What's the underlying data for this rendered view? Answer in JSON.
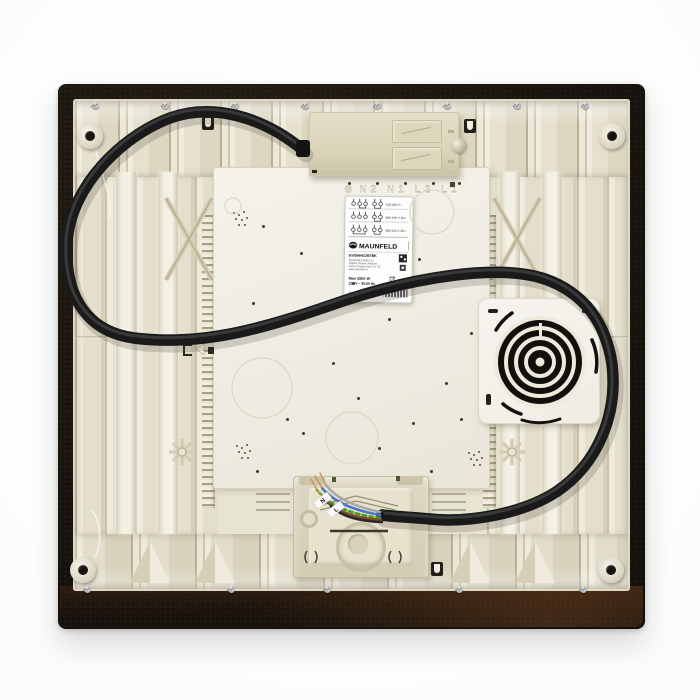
{
  "label": {
    "brand": "MAUNFELD",
    "model": "EVI594HZ2BTBK",
    "maker_lines": [
      "MAUNFELD RUS LLC",
      "105064, Russia, Moscow,",
      "Nizhny Susalny lane 5, b. 19",
      "www.maunfeld.ru"
    ],
    "max_power": "Max 6500 W",
    "voltage": "220 V ~ 50-60 Hz",
    "origin_line": "S/N 2105000000   Made in China",
    "ce_mark": "CE",
    "wiring_rows": [
      "220-240 V~",
      "380-415 V 2N~",
      "380-415 V 3N~"
    ]
  },
  "embossed": {
    "ground_symbol": "⊕",
    "terminals": "N2  N1  L2  L1"
  },
  "wire_tags": {
    "neutral": "N",
    "line": "L"
  },
  "colors": {
    "glass": "#17130f",
    "base_plastic": "#e8e4d4",
    "centre_plate": "#f2f0e7",
    "terminal_box": "#ddd6bc",
    "cable": "#1c1c1c",
    "wire_green": "#3f9b3f",
    "wire_yellow": "#e8d94a",
    "wire_blue": "#4f74c9",
    "wire_brown": "#7a4c28",
    "wire_grey": "#a9a9a9"
  }
}
